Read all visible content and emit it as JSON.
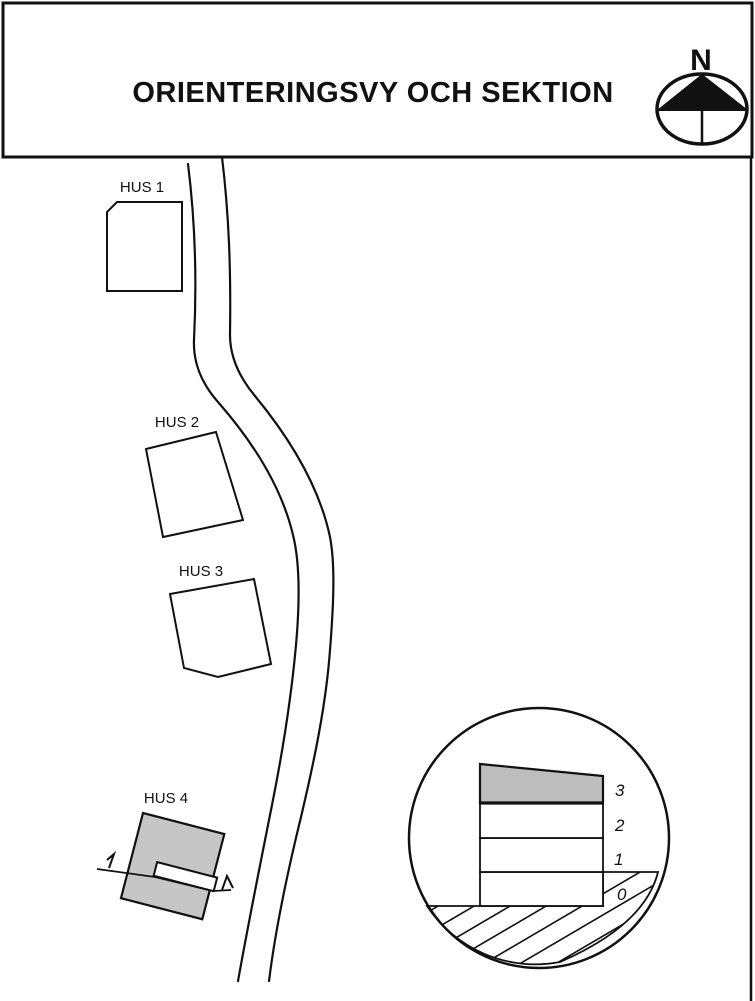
{
  "header": {
    "title": "ORIENTERINGSVY OCH SEKTION"
  },
  "compass": {
    "label": "N"
  },
  "site_plan": {
    "buildings": [
      {
        "label": "HUS 1",
        "fill": "white"
      },
      {
        "label": "HUS 2",
        "fill": "white"
      },
      {
        "label": "HUS 3",
        "fill": "white"
      },
      {
        "label": "HUS 4",
        "fill": "gray"
      }
    ]
  },
  "section_detail": {
    "floors": [
      {
        "label": "3",
        "fill": "gray"
      },
      {
        "label": "2",
        "fill": "white"
      },
      {
        "label": "1",
        "fill": "white"
      },
      {
        "label": "0",
        "fill": "white"
      }
    ]
  },
  "colors": {
    "line": "#111111",
    "building_gray": "#c6c6c6",
    "floor_gray": "#bdbdbd",
    "background": "#ffffff"
  }
}
